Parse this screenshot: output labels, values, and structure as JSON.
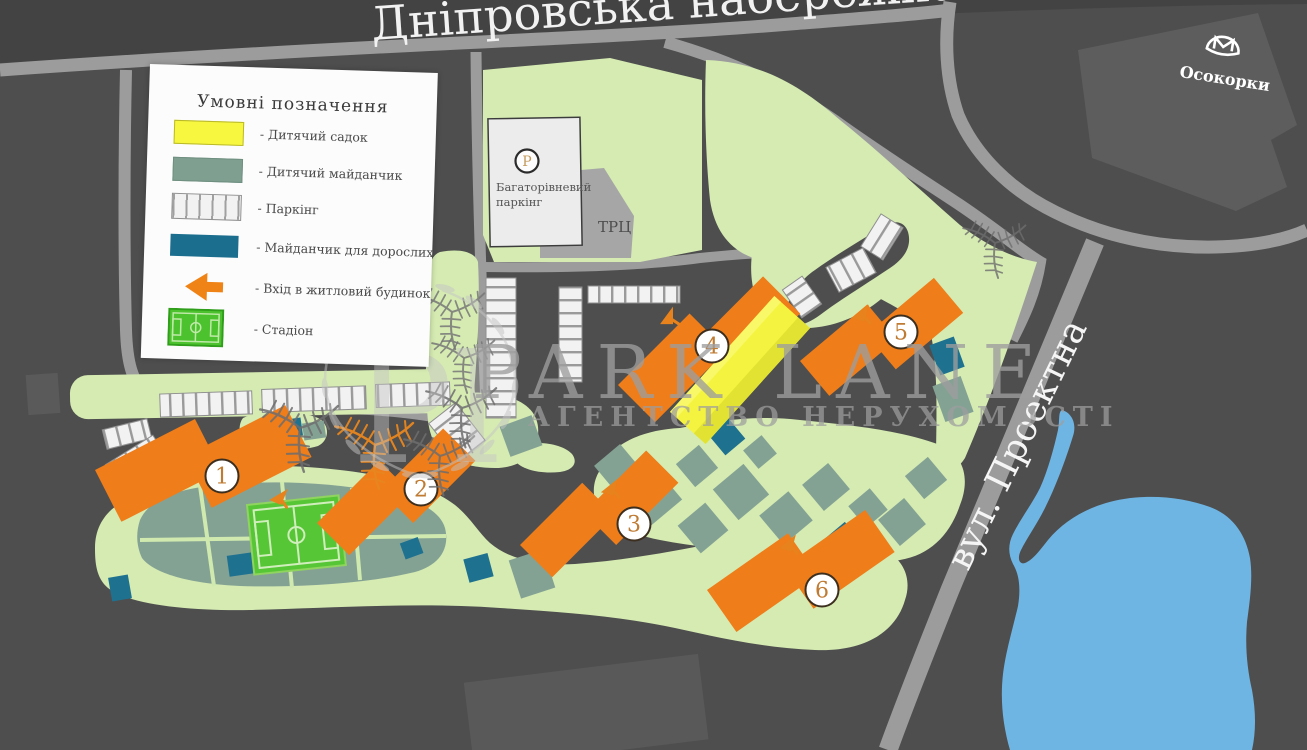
{
  "streets": {
    "top": "Дніпровська набережна",
    "right": "вул. Проектна"
  },
  "metro": {
    "station": "Осокорки"
  },
  "facilities": {
    "parking_symbol": "Р",
    "parking_line1": "Багаторівневий",
    "parking_line2": "паркінг",
    "mall": "ТРЦ"
  },
  "buildings": [
    {
      "number": "1"
    },
    {
      "number": "2"
    },
    {
      "number": "3"
    },
    {
      "number": "4"
    },
    {
      "number": "5"
    },
    {
      "number": "6"
    }
  ],
  "legend": {
    "title": "Умовні позначення",
    "items": [
      {
        "key": "kindergarten",
        "label": "- Дитячий садок"
      },
      {
        "key": "kids-playground",
        "label": "- Дитячий майданчик"
      },
      {
        "key": "parking",
        "label": "- Паркінг"
      },
      {
        "key": "adult-playground",
        "label": "- Майданчик для дорослих"
      },
      {
        "key": "entrance",
        "label": "- Вхід в житловий будинок"
      },
      {
        "key": "stadium",
        "label": "- Стадіон"
      }
    ]
  },
  "watermark": {
    "brand": "PARK LANE",
    "tagline": "АГЕНТСТВО НЕРУХОМОСТІ",
    "monogram": "Pl"
  },
  "colors": {
    "background": "#4e4e4e",
    "road": "#9c9c9c",
    "building_orange": "#ee7d1a",
    "kindergarten_yellow": "#f4f440",
    "kids_playground_sage": "#84a294",
    "adult_playground_teal": "#1f7190",
    "green": "#d5ebb2",
    "stadium_green": "#57c636",
    "pond_blue": "#6fb5e4"
  }
}
